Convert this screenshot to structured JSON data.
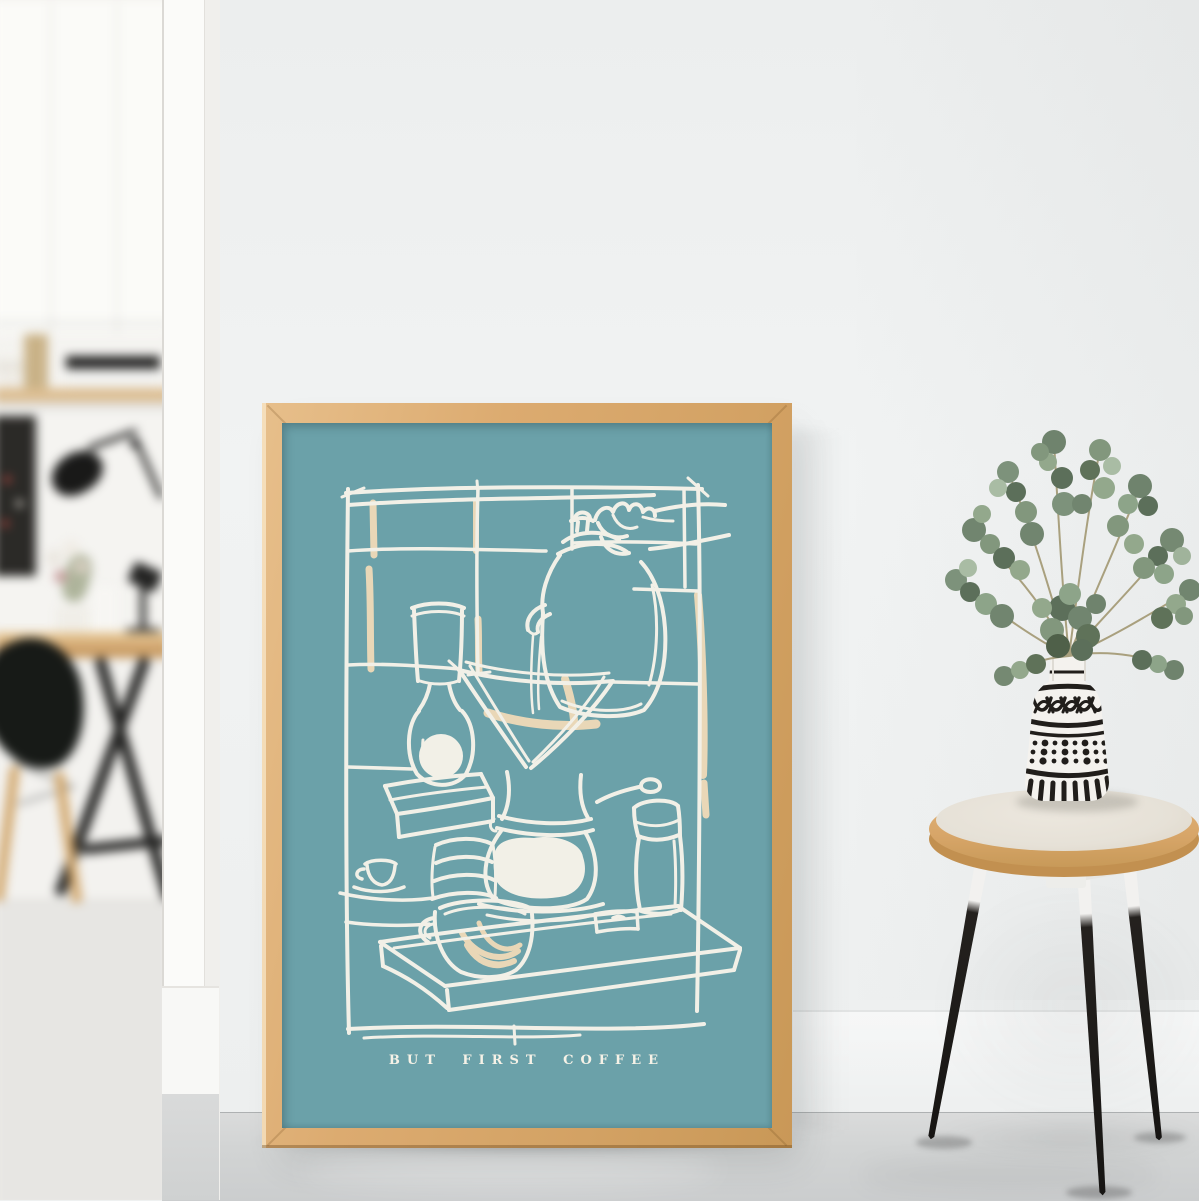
{
  "poster": {
    "caption": "BUT FIRST COFFEE",
    "subject": "hand-sketched pour-over coffee still life",
    "paper_color": "#6BA1A9",
    "ink_color": "#F7F3EA",
    "accent_color": "#EED9B8",
    "frame_wood_color": "#D9A96C",
    "depicted_items": [
      "hand pouring gooseneck kettle",
      "pour-over filter cone",
      "glass carafe with brewed coffee",
      "coffee mug with crema swirl",
      "hand coffee grinder",
      "espresso cup and saucer",
      "stack of paper filters",
      "tall glass",
      "small milk carafe",
      "wooden serving tray",
      "sketched tile wall"
    ]
  },
  "right_scene": {
    "stool": {
      "seat_color": "#D8A76B",
      "seat_top_color": "#E9E4DA",
      "leg_upper_color": "#F1F0EE",
      "leg_lower_color": "#1D1B19",
      "leg_count": 3
    },
    "vase": {
      "base_color": "#F4F2EE",
      "pattern_color": "#211E1B",
      "pattern_bands": [
        "petal arcs",
        "dot grid",
        "vertical stripes"
      ]
    },
    "plant": {
      "species": "eucalyptus",
      "leaf_colors": [
        "#71856F",
        "#82977D",
        "#93A88C",
        "#5C6F5A",
        "#A9BCA4"
      ]
    }
  },
  "left_scene": {
    "items": [
      "white cabinets",
      "wood wall shelf",
      "books",
      "radio",
      "black pinboard",
      "black desk lamp",
      "flower posy",
      "wooden desk",
      "black trestle legs",
      "black shell chair"
    ],
    "door_trim_color": "#FBFBF9"
  },
  "room": {
    "wall_color": "#EFF1F1",
    "floor_color": "#D3D4D4"
  }
}
